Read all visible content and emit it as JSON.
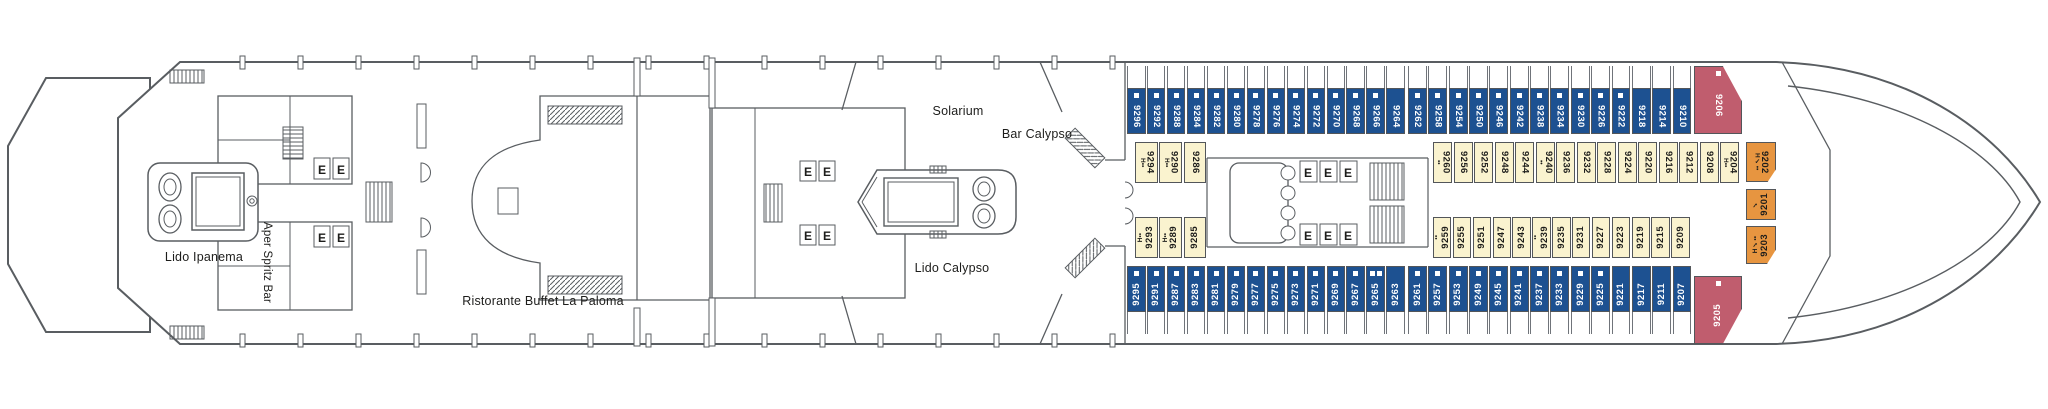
{
  "labels": {
    "lido_ipanema": "Lido Ipanema",
    "aper_spritz_bar": "Aper Spritz Bar",
    "ristorante_buffet": "Ristorante Buffet La Paloma",
    "solarium": "Solarium",
    "bar_calypso": "Bar Calypso",
    "lido_calypso": "Lido Calypso"
  },
  "icons": {
    "elevator_letter": "E"
  },
  "colors": {
    "cabin_blue": "#1d5191",
    "cabin_yellow": "#faf3cf",
    "cabin_red": "#c05d6e",
    "cabin_orange": "#e79540",
    "line": "#595d61",
    "text": "#1d1d1b"
  },
  "mark_glyphs": {
    "H": "H",
    "dots": "••",
    "check": "✓",
    "sq": "■"
  },
  "cabin_rows": {
    "top_outer": {
      "color": "blue",
      "cabins": [
        {
          "num": "9296",
          "marks": [
            "sq"
          ]
        },
        {
          "num": "9292",
          "marks": [
            "sq"
          ]
        },
        {
          "num": "9288",
          "marks": [
            "sq"
          ]
        },
        {
          "num": "9284",
          "marks": [
            "sq"
          ]
        },
        {
          "num": "9282",
          "marks": [
            "sq"
          ]
        },
        {
          "num": "9280",
          "marks": [
            "sq"
          ]
        },
        {
          "num": "9278",
          "marks": [
            "sq"
          ]
        },
        {
          "num": "9276",
          "marks": [
            "sq"
          ]
        },
        {
          "num": "9274",
          "marks": [
            "sq"
          ]
        },
        {
          "num": "9272",
          "marks": [
            "sq"
          ]
        },
        {
          "num": "9270",
          "marks": [
            "sq"
          ]
        },
        {
          "num": "9268",
          "marks": [
            "sq"
          ]
        },
        {
          "num": "9266",
          "marks": [
            "sq"
          ]
        },
        {
          "num": "9264",
          "marks": []
        },
        {
          "num": "9262",
          "marks": [
            "sq"
          ]
        },
        {
          "num": "9258",
          "marks": [
            "sq"
          ]
        },
        {
          "num": "9254",
          "marks": [
            "sq"
          ]
        },
        {
          "num": "9250",
          "marks": [
            "sq"
          ]
        },
        {
          "num": "9246",
          "marks": [
            "sq"
          ]
        },
        {
          "num": "9242",
          "marks": [
            "sq"
          ]
        },
        {
          "num": "9238",
          "marks": [
            "sq"
          ]
        },
        {
          "num": "9234",
          "marks": [
            "sq"
          ]
        },
        {
          "num": "9230",
          "marks": [
            "sq"
          ]
        },
        {
          "num": "9226",
          "marks": [
            "sq"
          ]
        },
        {
          "num": "9222",
          "marks": [
            "sq"
          ]
        },
        {
          "num": "9218",
          "marks": []
        },
        {
          "num": "9214",
          "marks": []
        },
        {
          "num": "9210",
          "marks": []
        }
      ]
    },
    "top_inner": {
      "color": "yellow",
      "cabins": [
        {
          "num": "9294",
          "marks": [
            "H",
            "dots"
          ]
        },
        {
          "num": "9290",
          "marks": [
            "H",
            "dots"
          ]
        },
        {
          "num": "9286",
          "marks": []
        },
        {
          "num": "9260",
          "marks": [
            "dots"
          ]
        },
        {
          "num": "9256",
          "marks": []
        },
        {
          "num": "9252",
          "marks": []
        },
        {
          "num": "9248",
          "marks": []
        },
        {
          "num": "9244",
          "marks": []
        },
        {
          "num": "9240",
          "marks": [
            "dots"
          ]
        },
        {
          "num": "9236",
          "marks": []
        },
        {
          "num": "9232",
          "marks": []
        },
        {
          "num": "9228",
          "marks": []
        },
        {
          "num": "9224",
          "marks": []
        },
        {
          "num": "9220",
          "marks": []
        },
        {
          "num": "9216",
          "marks": []
        },
        {
          "num": "9212",
          "marks": []
        },
        {
          "num": "9208",
          "marks": []
        },
        {
          "num": "9204",
          "marks": [
            "H",
            "dots"
          ]
        }
      ]
    },
    "bottom_inner": {
      "color": "yellow",
      "cabins": [
        {
          "num": "9293",
          "marks": [
            "H",
            "dots"
          ]
        },
        {
          "num": "9289",
          "marks": [
            "H",
            "dots"
          ]
        },
        {
          "num": "9285",
          "marks": []
        },
        {
          "num": "9259",
          "marks": [
            "dots"
          ]
        },
        {
          "num": "9255",
          "marks": []
        },
        {
          "num": "9251",
          "marks": []
        },
        {
          "num": "9247",
          "marks": []
        },
        {
          "num": "9243",
          "marks": []
        },
        {
          "num": "9239",
          "marks": [
            "dots"
          ]
        },
        {
          "num": "9235",
          "marks": []
        },
        {
          "num": "9231",
          "marks": []
        },
        {
          "num": "9227",
          "marks": []
        },
        {
          "num": "9223",
          "marks": []
        },
        {
          "num": "9219",
          "marks": []
        },
        {
          "num": "9215",
          "marks": []
        },
        {
          "num": "9209",
          "marks": []
        }
      ]
    },
    "bottom_outer": {
      "color": "blue",
      "cabins": [
        {
          "num": "9295",
          "marks": [
            "sq"
          ]
        },
        {
          "num": "9291",
          "marks": [
            "sq"
          ]
        },
        {
          "num": "9287",
          "marks": [
            "sq"
          ]
        },
        {
          "num": "9283",
          "marks": [
            "sq"
          ]
        },
        {
          "num": "9281",
          "marks": [
            "sq"
          ]
        },
        {
          "num": "9279",
          "marks": [
            "sq"
          ]
        },
        {
          "num": "9277",
          "marks": [
            "sq"
          ]
        },
        {
          "num": "9275",
          "marks": [
            "sq"
          ]
        },
        {
          "num": "9273",
          "marks": [
            "sq"
          ]
        },
        {
          "num": "9271",
          "marks": [
            "sq"
          ]
        },
        {
          "num": "9269",
          "marks": [
            "sq"
          ]
        },
        {
          "num": "9267",
          "marks": [
            "sq"
          ]
        },
        {
          "num": "9265",
          "marks": [
            "sq",
            "sq"
          ]
        },
        {
          "num": "9263",
          "marks": []
        },
        {
          "num": "9261",
          "marks": [
            "sq"
          ]
        },
        {
          "num": "9257",
          "marks": [
            "sq"
          ]
        },
        {
          "num": "9253",
          "marks": [
            "sq"
          ]
        },
        {
          "num": "9249",
          "marks": [
            "sq"
          ]
        },
        {
          "num": "9245",
          "marks": [
            "sq"
          ]
        },
        {
          "num": "9241",
          "marks": [
            "sq"
          ]
        },
        {
          "num": "9237",
          "marks": [
            "sq"
          ]
        },
        {
          "num": "9233",
          "marks": [
            "sq"
          ]
        },
        {
          "num": "9229",
          "marks": [
            "sq"
          ]
        },
        {
          "num": "9225",
          "marks": [
            "sq"
          ]
        },
        {
          "num": "9221",
          "marks": []
        },
        {
          "num": "9217",
          "marks": []
        },
        {
          "num": "9211",
          "marks": []
        },
        {
          "num": "9207",
          "marks": []
        }
      ]
    },
    "bow": {
      "cabins": [
        {
          "num": "9206",
          "color": "red",
          "marks": [
            "sq"
          ]
        },
        {
          "num": "9202",
          "color": "orange",
          "marks": [
            "H",
            "check",
            "dots"
          ]
        },
        {
          "num": "9201",
          "color": "orange",
          "marks": [
            "check"
          ]
        },
        {
          "num": "9203",
          "color": "orange",
          "marks": [
            "H",
            "check",
            "dots"
          ]
        },
        {
          "num": "9205",
          "color": "red",
          "marks": [
            "sq"
          ]
        }
      ]
    }
  }
}
